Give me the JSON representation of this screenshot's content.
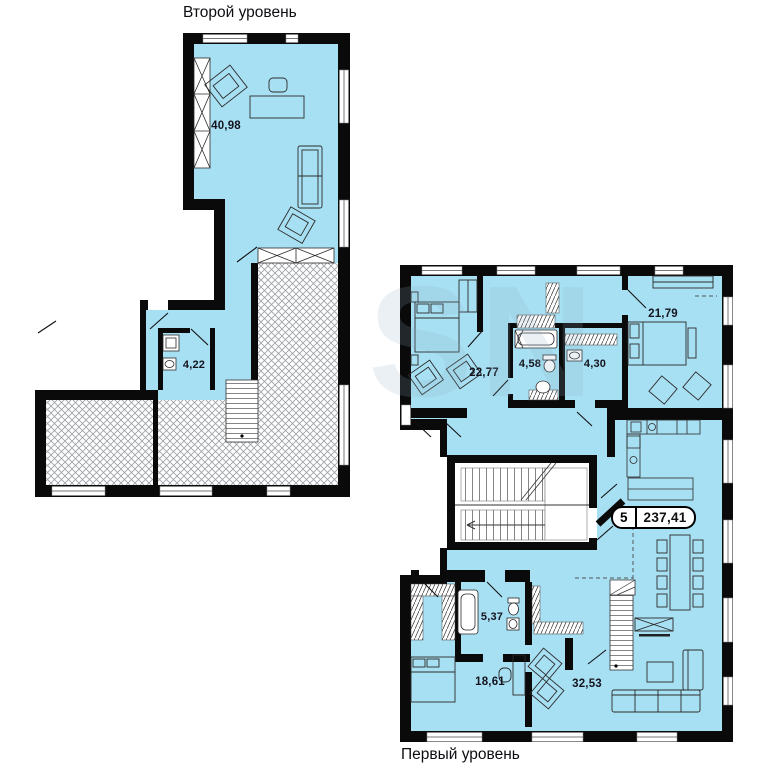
{
  "upper_plan": {
    "title": "Второй уровень",
    "rooms": [
      {
        "area": "40,98"
      },
      {
        "area": "4,22"
      }
    ]
  },
  "lower_plan": {
    "title": "Первый уровень",
    "rooms": [
      {
        "area": "22,77"
      },
      {
        "area": "4,58"
      },
      {
        "area": "4,30"
      },
      {
        "area": "21,79"
      },
      {
        "area": "5,37"
      },
      {
        "area": "18,61"
      },
      {
        "area": "32,53"
      }
    ]
  },
  "badge": {
    "rooms_count": "5",
    "total_area": "237,41"
  },
  "watermark": "SN",
  "colors": {
    "floor_fill": "#a8e0f3",
    "wall": "#0a0a0a",
    "hatch_line": "#9aa0a6"
  }
}
